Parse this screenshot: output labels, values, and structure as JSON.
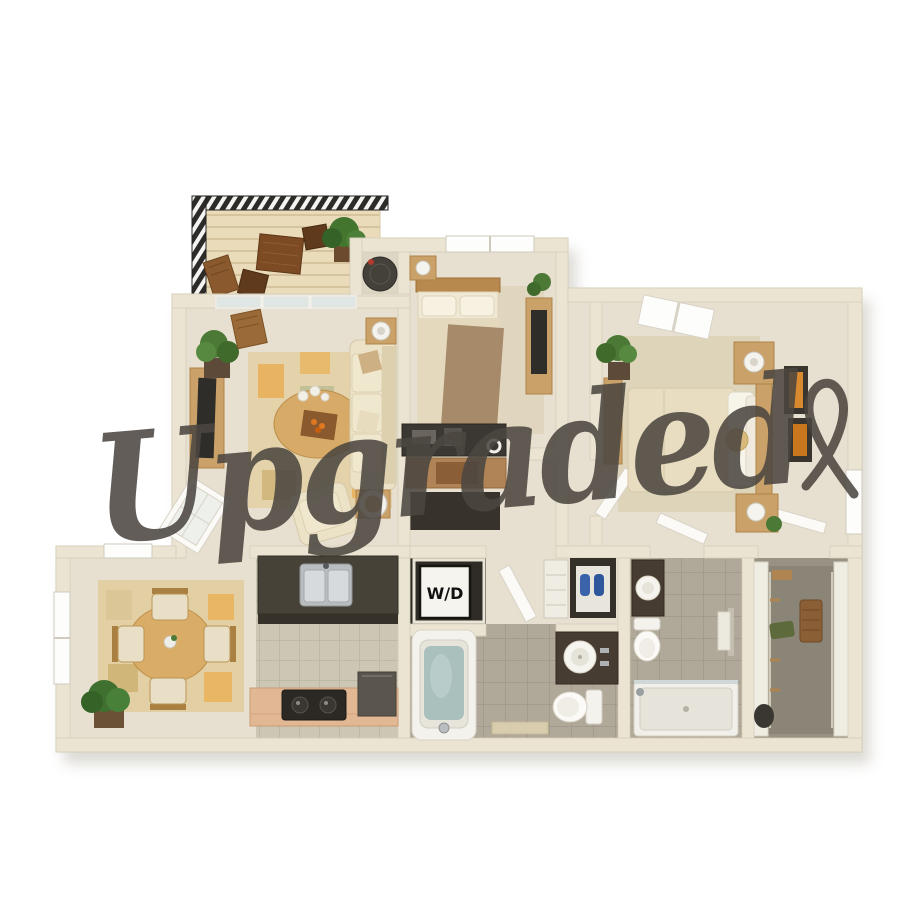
{
  "page": {
    "background": "#ffffff",
    "content": "3D rendered apartment floor plan, top-down view"
  },
  "watermark": {
    "text": "Upgraded",
    "color": "#4b4640"
  },
  "labels": {
    "washer_dryer": "W/D"
  },
  "palette": {
    "wall": "#ebe4d2",
    "carpet": "#e7e0d0",
    "kitchen_tile": "#cdc6b5",
    "bath_tile": "#b0a899",
    "deck": "#eadcba",
    "railing": "#2d2b28",
    "counter_dark": "#474238",
    "counter_peach": "#e2b794",
    "wood": "#c9a169",
    "sofa_cream": "#ece2c8",
    "bedding_tan": "#a78a69",
    "bedding_cream": "#e8ddc0",
    "rug_tan": "#e3d0a6",
    "accent_orange": "#e07820",
    "plant_green": "#4c7a36",
    "tub_water": "#a9c0bd"
  },
  "rooms": [
    "balcony",
    "living-room",
    "utility-closet",
    "bedroom",
    "master-bedroom",
    "den-nook",
    "hallway",
    "dining-room",
    "kitchen",
    "laundry-closet",
    "bathroom",
    "second-bathroom",
    "walk-in-closet"
  ]
}
